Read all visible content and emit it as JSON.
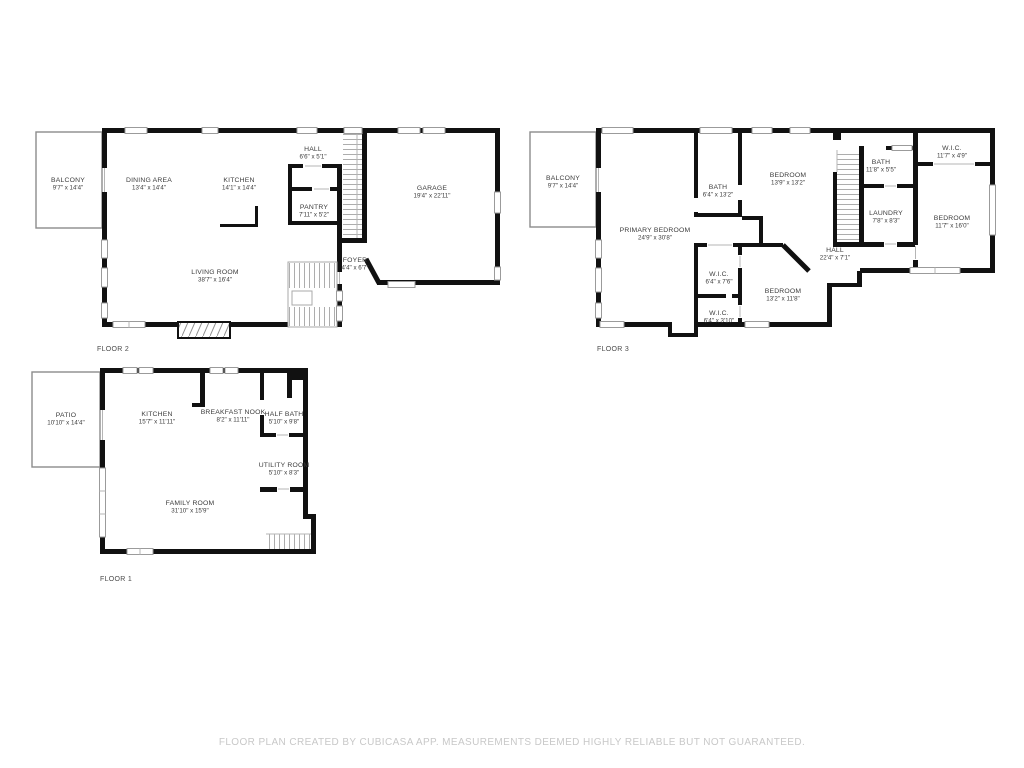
{
  "footer": {
    "text": "FLOOR PLAN CREATED BY CUBICASA APP. MEASUREMENTS DEEMED HIGHLY RELIABLE BUT NOT GUARANTEED."
  },
  "colors": {
    "wall": "#111111",
    "window_border": "#9b9b9b",
    "stair_line": "#adadad",
    "label": "#3c3c3c",
    "footer_text": "#c8c8c8",
    "outdoor_wall": "#8c8c8c"
  },
  "floors": [
    {
      "label": "FLOOR 2",
      "rooms": [
        {
          "name": "BALCONY",
          "dims": "9'7\" x 14'4\""
        },
        {
          "name": "DINING AREA",
          "dims": "13'4\" x 14'4\""
        },
        {
          "name": "KITCHEN",
          "dims": "14'1\" x 14'4\""
        },
        {
          "name": "HALL",
          "dims": "6'6\" x 5'1\""
        },
        {
          "name": "PANTRY",
          "dims": "7'11\" x 5'2\""
        },
        {
          "name": "GARAGE",
          "dims": "19'4\" x 22'11\""
        },
        {
          "name": "FOYER",
          "dims": "4'4\" x 6'7\""
        },
        {
          "name": "LIVING ROOM",
          "dims": "38'7\" x 16'4\""
        }
      ]
    },
    {
      "label": "FLOOR 3",
      "rooms": [
        {
          "name": "BALCONY",
          "dims": "9'7\" x 14'4\""
        },
        {
          "name": "PRIMARY BEDROOM",
          "dims": "24'9\" x 30'8\""
        },
        {
          "name": "BATH",
          "dims": "6'4\" x 13'2\""
        },
        {
          "name": "BEDROOM",
          "dims": "13'9\" x 13'2\""
        },
        {
          "name": "BATH",
          "dims": "11'8\" x 5'5\""
        },
        {
          "name": "W.I.C.",
          "dims": "11'7\" x 4'9\""
        },
        {
          "name": "LAUNDRY",
          "dims": "7'8\" x 8'3\""
        },
        {
          "name": "BEDROOM",
          "dims": "11'7\" x 16'0\""
        },
        {
          "name": "HALL",
          "dims": "22'4\" x 7'1\""
        },
        {
          "name": "W.I.C.",
          "dims": "6'4\" x 7'6\""
        },
        {
          "name": "W.I.C.",
          "dims": "6'4\" x 3'10\""
        },
        {
          "name": "BEDROOM",
          "dims": "13'2\" x 11'8\""
        }
      ]
    },
    {
      "label": "FLOOR 1",
      "rooms": [
        {
          "name": "PATIO",
          "dims": "10'10\" x 14'4\""
        },
        {
          "name": "KITCHEN",
          "dims": "15'7\" x 11'11\""
        },
        {
          "name": "BREAKFAST NOOK",
          "dims": "8'2\" x 11'11\""
        },
        {
          "name": "HALF BATH",
          "dims": "5'10\" x 9'8\""
        },
        {
          "name": "UTILITY ROOM",
          "dims": "5'10\" x 8'3\""
        },
        {
          "name": "FAMILY ROOM",
          "dims": "31'10\" x 15'9\""
        }
      ]
    }
  ]
}
